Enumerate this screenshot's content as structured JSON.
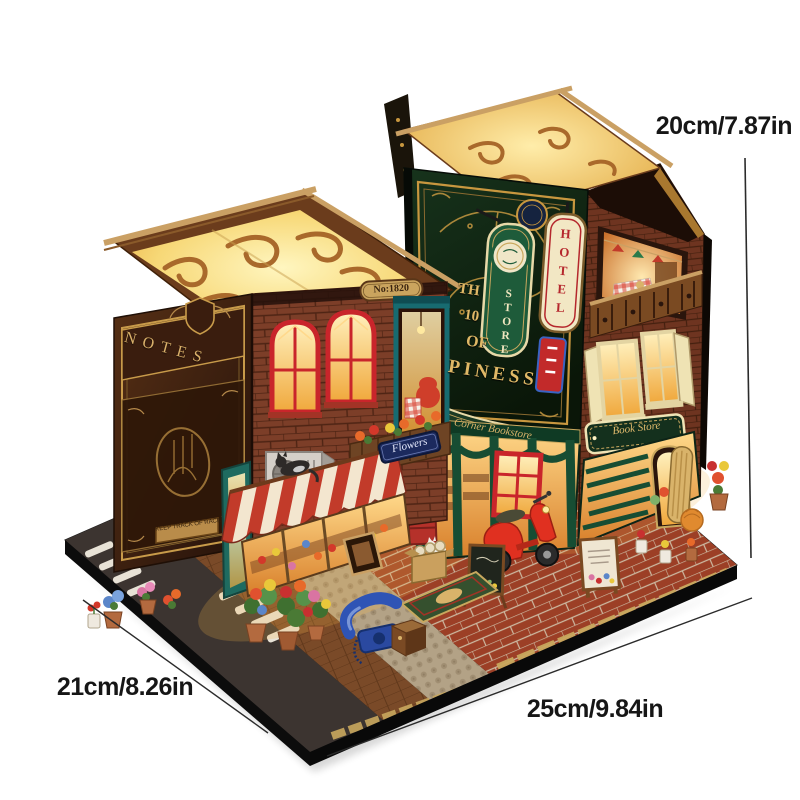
{
  "dimensions": {
    "height_label": "20cm/7.87in",
    "depth_label": "21cm/8.26in",
    "width_label": "25cm/9.84in"
  },
  "signs": {
    "spine_title": "NOTES",
    "spine_plaque": "KEEP TRACK OF RACE",
    "house_number": "No:1820",
    "flower_shop_sign": "Flowers",
    "store_sign": "STORE",
    "hotel_sign": "HOTEL",
    "happiness_sign": {
      "line1": "TH",
      "line2": "10",
      "line3": "OF",
      "line4": "PINESS"
    },
    "front_banner": "Corner Bookstore",
    "side_sign": "Book Store"
  },
  "colors": {
    "background": "#ffffff",
    "annotation_text": "#161616",
    "dimension_line": "#2b2b2b",
    "warm_glow": "#ffd98a",
    "brick_red": "#7c3e28",
    "book_cover_green": "#10240f",
    "awning_red": "#c23b2a",
    "awning_cream": "#f3e6cf",
    "scooter_red": "#e03020",
    "base_black": "#0c0c0c",
    "gold_trim": "#c8973f"
  }
}
